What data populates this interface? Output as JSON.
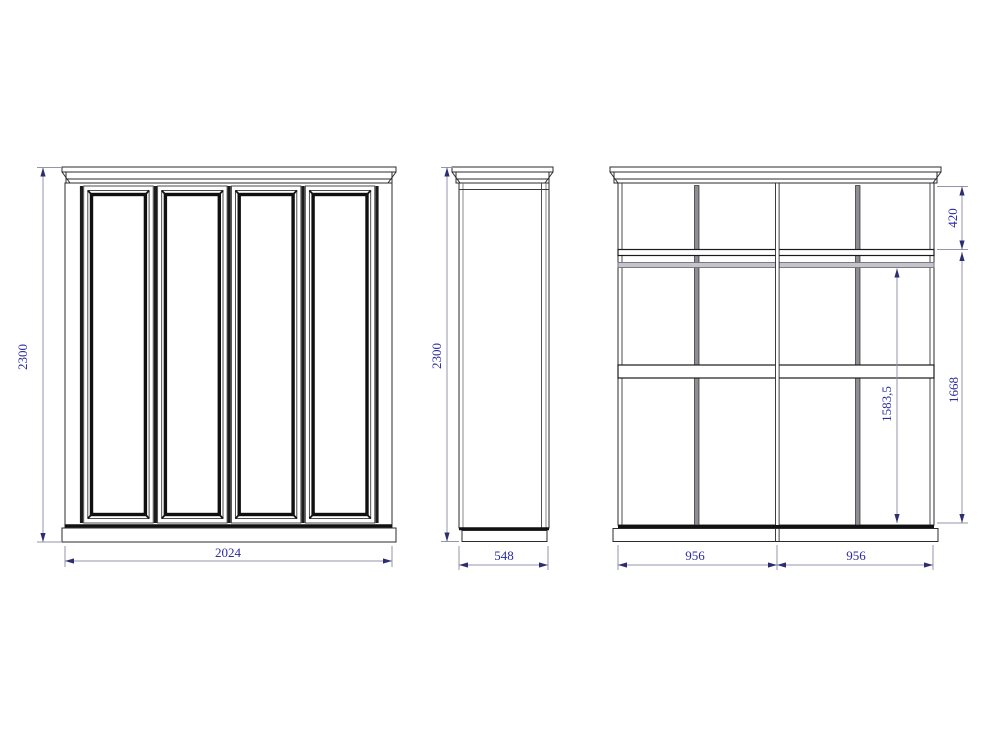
{
  "drawing": {
    "kind": "wardrobe three-view technical drawing",
    "front": {
      "dim_height": "2300",
      "dim_width": "2024"
    },
    "side": {
      "dim_height": "2300",
      "dim_depth": "548"
    },
    "interior": {
      "dim_top_section": "420",
      "dim_inner_height": "1668",
      "dim_rail_height": "1583,5",
      "dim_bay_left": "956",
      "dim_bay_right": "956"
    }
  },
  "colors": {
    "background": "#ffffff",
    "outline": "#2b2b2b",
    "panel_stroke": "#101010",
    "door_edge_strip": "#1c1c1c",
    "divider_fill": "#8e8e94",
    "rail_fill": "#c4c4ca",
    "dimension_line": "#9494ac",
    "dimension_arrow": "#2d2d72",
    "dimension_text": "#2b2ba0"
  }
}
